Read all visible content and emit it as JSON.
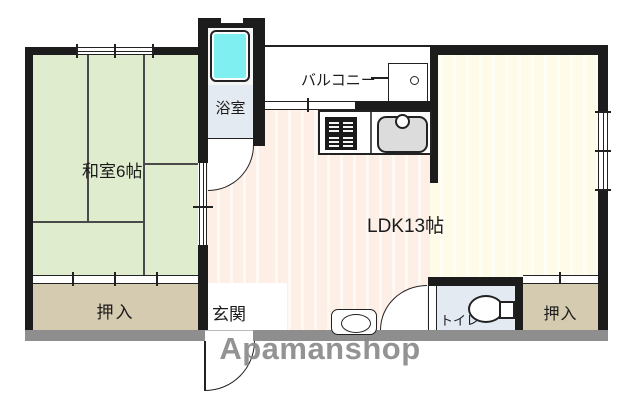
{
  "floorplan": {
    "rooms": {
      "washitsu": {
        "label": "和室6帖"
      },
      "bathroom": {
        "label": "浴室"
      },
      "balcony": {
        "label": "バルコニー"
      },
      "ldk": {
        "label": "LDK13帖"
      },
      "closet_left": {
        "label": "押入"
      },
      "closet_right": {
        "label": "押入"
      },
      "genkan": {
        "label": "玄関"
      },
      "toilet": {
        "label": "トイレ"
      }
    },
    "watermark": "Apamanshop",
    "colors": {
      "wall": "#1c1c1c",
      "outer_wall_shadow": "#8e8e8e",
      "tatami_floor": "#e0ecce",
      "closet_floor": "#d5cbb0",
      "ldk_floor": "#fdeee6",
      "living_floor": "#fefce8",
      "wet_area_floor": "#e3eaf2",
      "bathtub": "#80eff1",
      "watermark_grey": "#8a8a8a"
    }
  }
}
